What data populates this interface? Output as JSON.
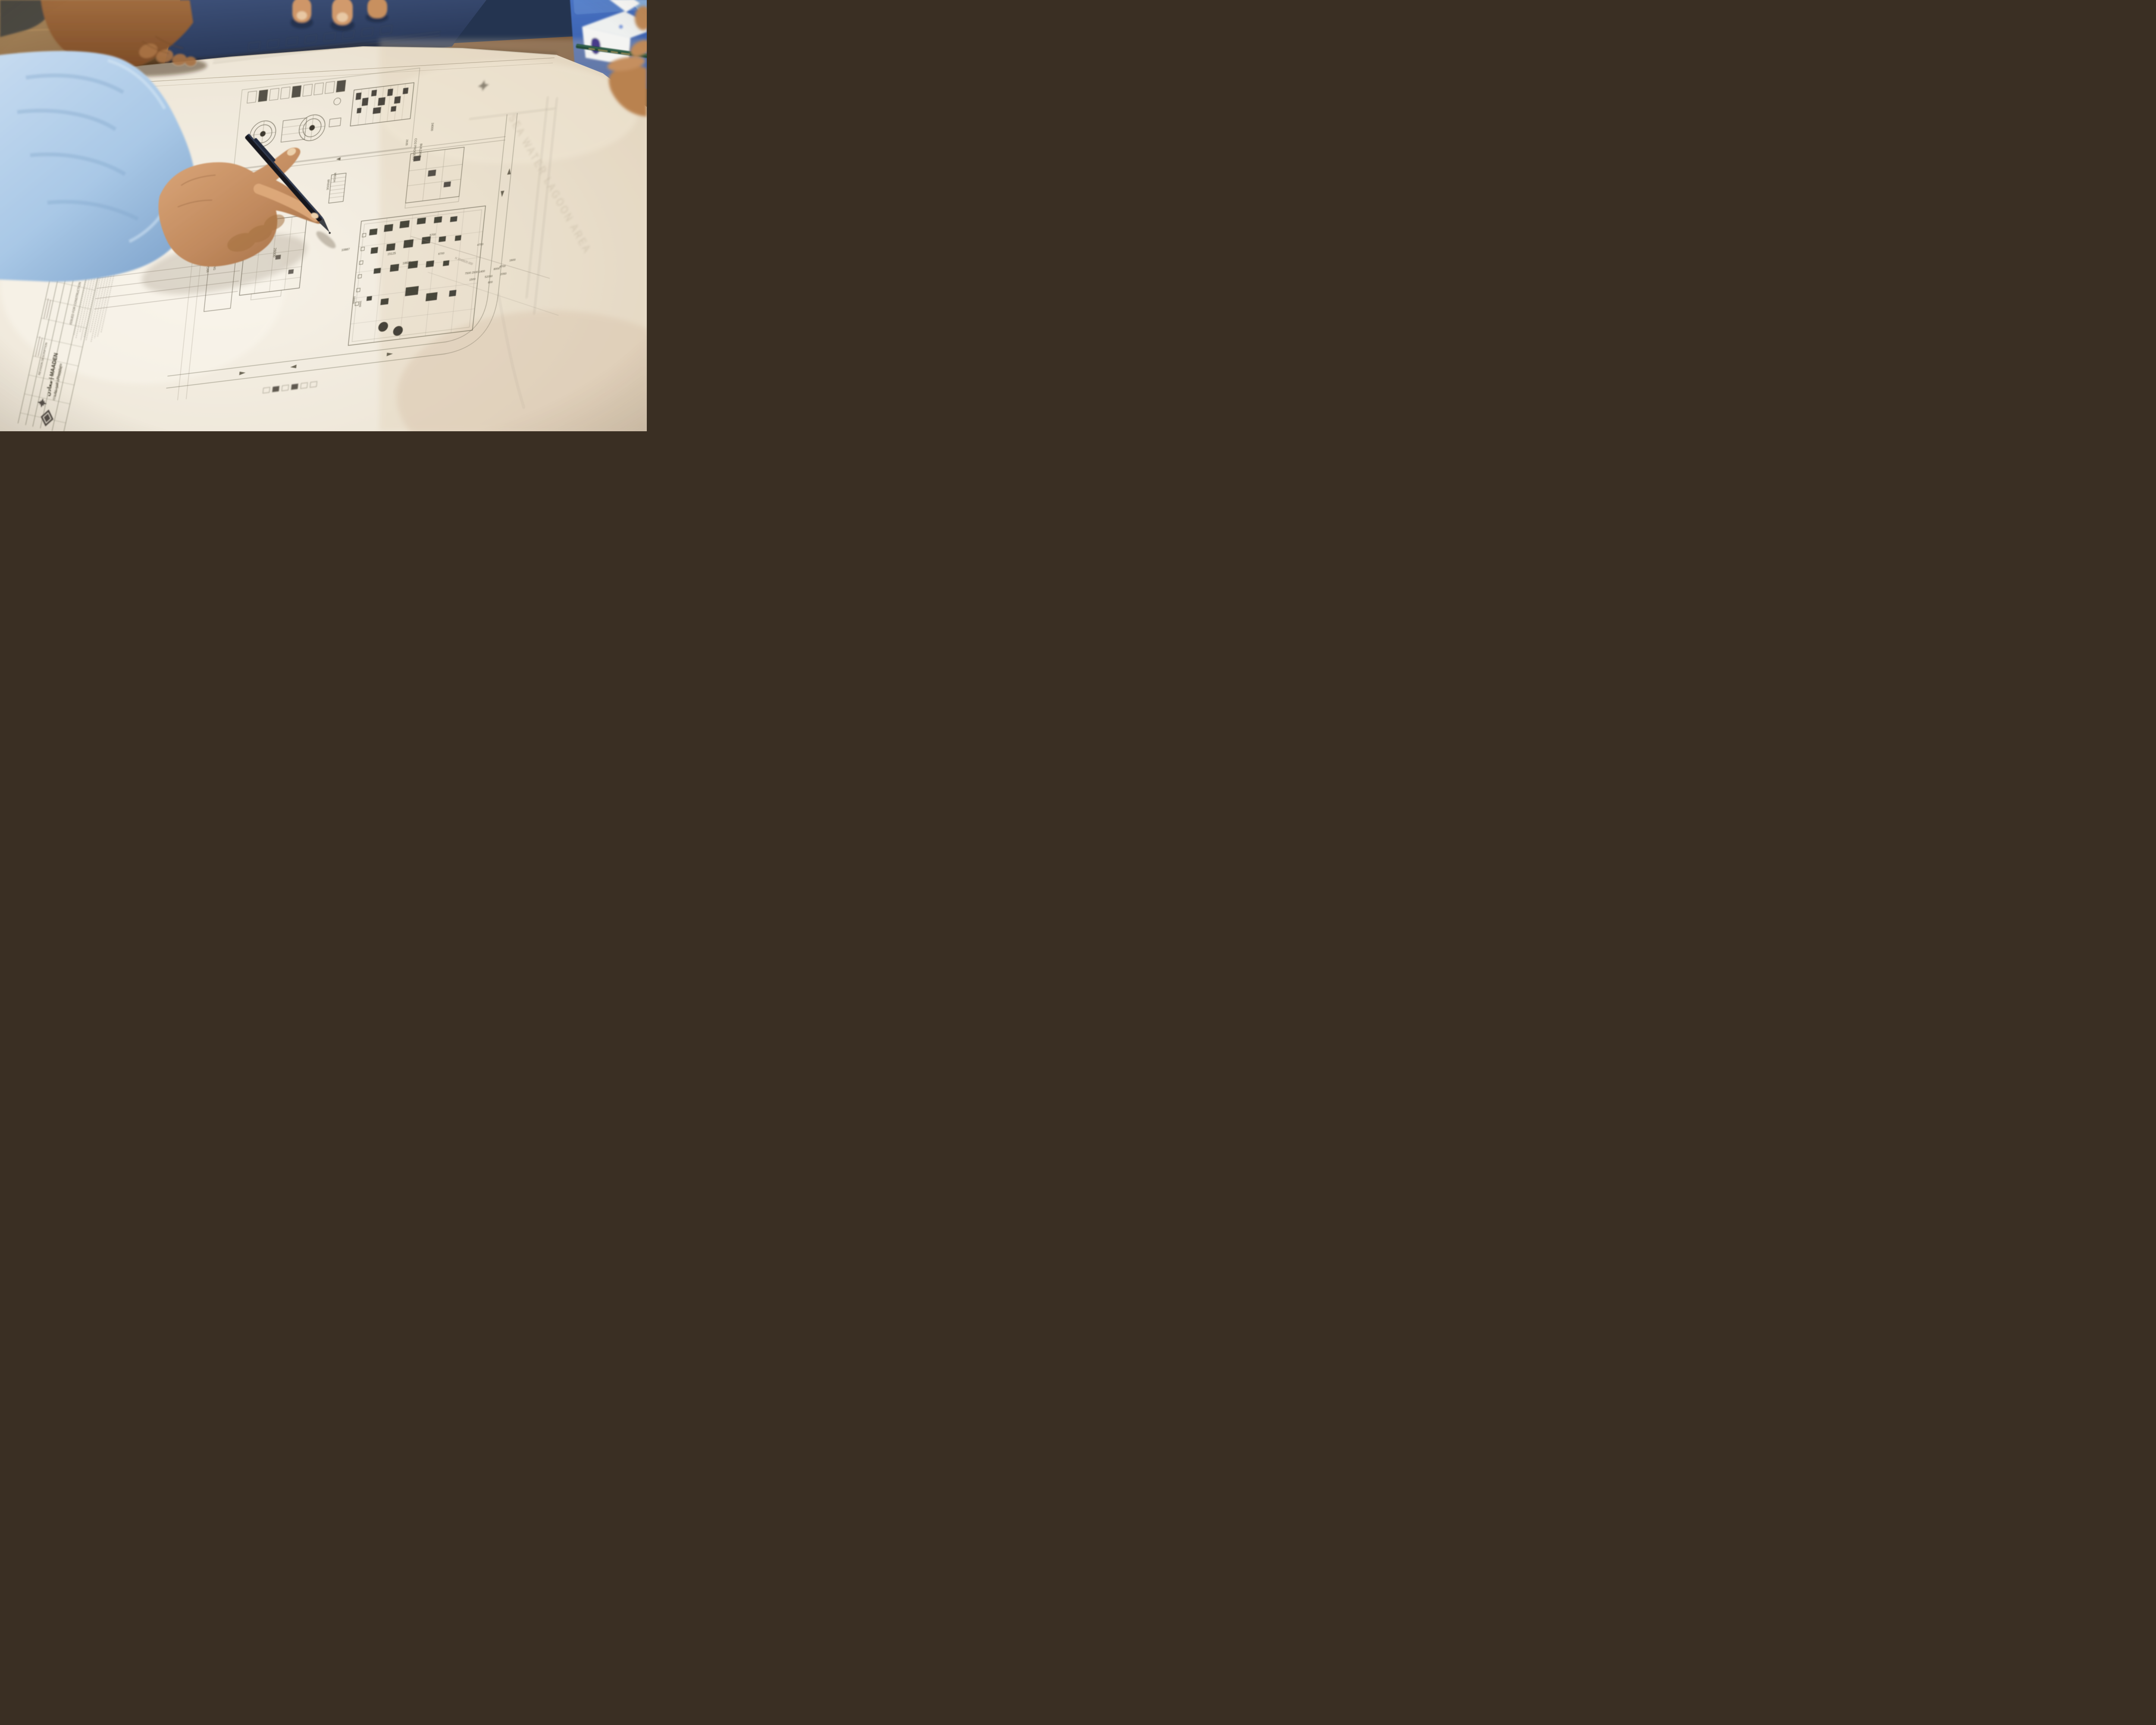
{
  "scene_caption": "Hands reviewing a Ma'aden Phosphate construction site-plan drawing on a table",
  "colors": {
    "paper": "#efe8da",
    "ink": "#55503f",
    "ink_light": "#8a8173",
    "wood": "#8a6742",
    "mat_navy": "#2c3a58",
    "folder_blue": "#3c63b1",
    "sleeve_blue": "#aecbe8",
    "skin": "#c18a5e",
    "pen_black": "#16191e",
    "pencil_green": "#224b38",
    "logo_gray": "#56524a",
    "logo_purple": "#473a8a",
    "tissue_white": "#f4f4f2"
  },
  "brand": {
    "line1": "معادن | MAADEN",
    "line2": "الفوسفات | Phosphate"
  },
  "revision_table": {
    "header": "REVISION DESCRIPTION",
    "rows": [
      "ISSUED FOR CONSTRUCTION",
      "ISSUED FOR APPROVAL"
    ]
  },
  "plan": {
    "labels": {
      "admin1": "ADMINISTRATION",
      "admin2": "BUILDING",
      "parking1": "CAR",
      "parking2": "COVERED PARKING",
      "weigh1": "WEIGH",
      "weigh2": "BRIDGE",
      "co21": "CO2 PROCESS",
      "co22": "BUILDING",
      "area": "SEA WATER LAGOON AREA",
      "grid_north": "N 3049920.000"
    },
    "dims": {
      "a": "5400",
      "b": "26000",
      "c": "24000",
      "d": "2635",
      "e": "15125",
      "f": "10887",
      "g": "10000",
      "h": "1640",
      "i": "18825",
      "j": "7500 2500 1400",
      "k": "8000",
      "l": "1600",
      "m": "600",
      "n": "52050",
      "o": "2050",
      "p": "6700",
      "q": "6700",
      "r": "4700",
      "s": "4700",
      "t": "1500"
    }
  }
}
